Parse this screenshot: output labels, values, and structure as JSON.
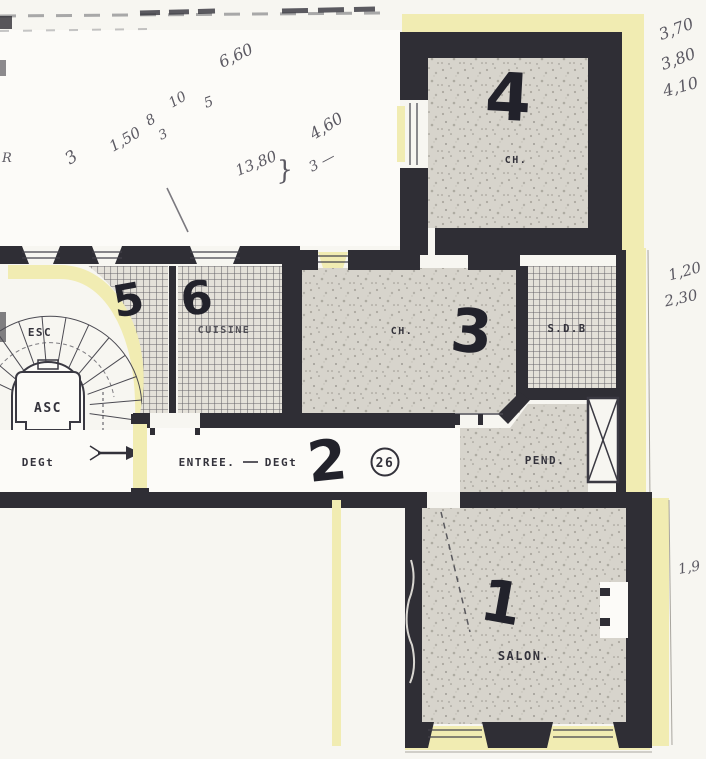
{
  "colors": {
    "wall": "#2f2e35",
    "yellow": "#f1ecb2",
    "paper": "#f7f6f1",
    "room": "#d7d4cc",
    "hatch_bg": "#e4e1d9",
    "hatch_line": "#514f57",
    "ink": "#33323b",
    "marker": "#22222b",
    "pencil": "#5b5962",
    "white_room": "#fcfbf8"
  },
  "rooms": {
    "salon": {
      "number": "1",
      "label": "SALON."
    },
    "hall": {
      "number": "2",
      "label_a": "ENTREE.",
      "label_b": "DEGt",
      "door_number": "26"
    },
    "bedroom3": {
      "number": "3",
      "label": "CH."
    },
    "bedroom4": {
      "number": "4",
      "label": "CH."
    },
    "wc": {
      "number": "5"
    },
    "kitchen": {
      "number": "6",
      "label": "CUISINE"
    },
    "bathroom": {
      "label": "S.D.B"
    },
    "closet": {
      "label": "PEND."
    },
    "stairs": {
      "label": "ESC"
    },
    "elevator": {
      "label": "ASC"
    },
    "landing": {
      "label": "DEGt"
    }
  },
  "measurements": {
    "top_left": [
      "3",
      "1,50",
      "8",
      "10",
      "3",
      "5",
      "6,60",
      "13,80",
      "}",
      "4,60",
      "3 —"
    ],
    "right_margin": [
      "3,70",
      "3,80",
      "4,10",
      "1,20",
      "2,30",
      "1,9"
    ],
    "left_edge": "R"
  }
}
